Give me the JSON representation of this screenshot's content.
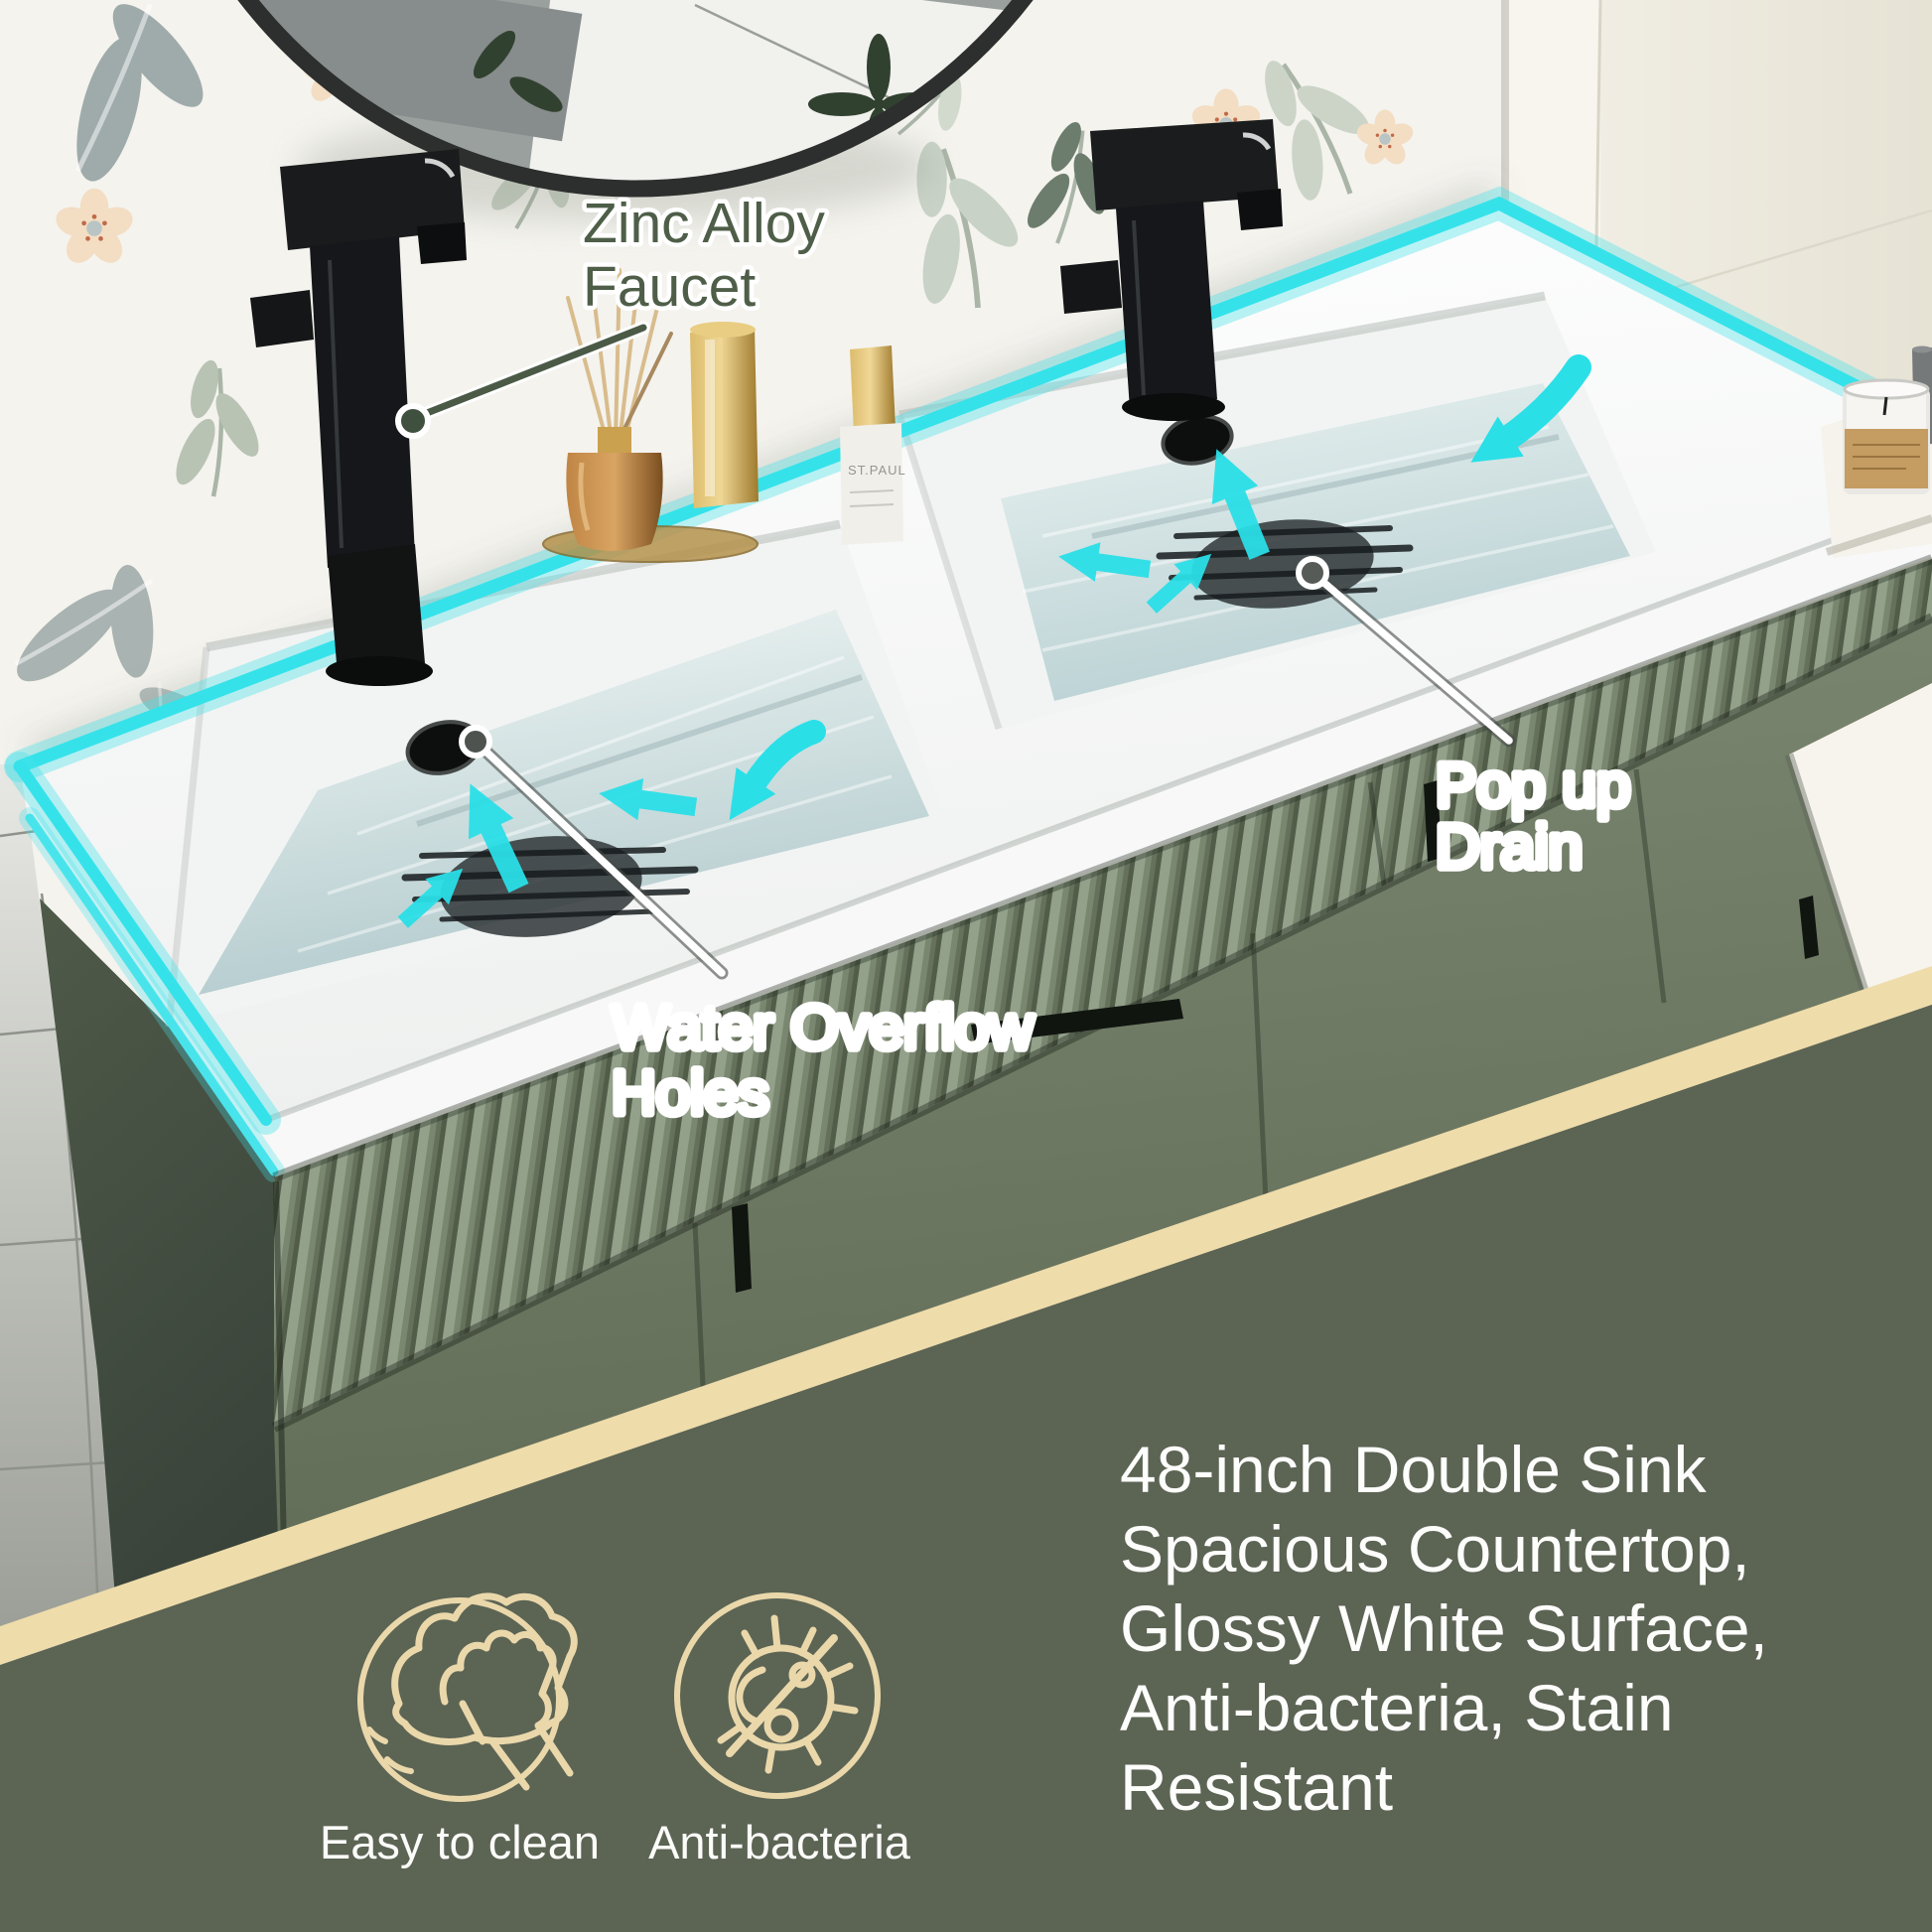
{
  "callouts": {
    "faucet": {
      "lines": [
        "Zinc Alloy",
        "Faucet"
      ]
    },
    "overflow": {
      "lines": [
        "Water Overflow",
        "Holes"
      ]
    },
    "drain": {
      "lines": [
        "Pop up",
        "Drain"
      ]
    }
  },
  "counter_items": {
    "bottle_label": "ST.PAUL"
  },
  "features": [
    {
      "icon": "easy-to-clean-icon",
      "label": "Easy to clean"
    },
    {
      "icon": "anti-bacteria-icon",
      "label": "Anti-bacteria"
    }
  ],
  "description": {
    "lines": [
      "48-inch Double Sink",
      "Spacious Countertop,",
      "Glossy White Surface,",
      "Anti-bacteria, Stain",
      "Resistant"
    ]
  },
  "colors": {
    "accent_cyan": "#2BDFE7",
    "band_beige": "#EEDCAB",
    "panel_green": "#5C6454",
    "icon_beige": "#EAD8AB",
    "cabinet_green": "#76826B",
    "callout_text_green": "#4E5E48",
    "text_white": "#FDFDFC"
  }
}
